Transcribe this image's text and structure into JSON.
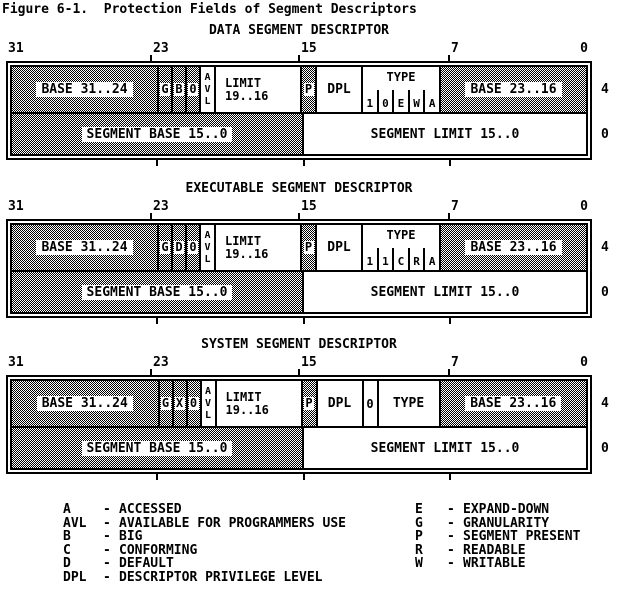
{
  "figure_title": "Figure 6-1.  Protection Fields of Segment Descriptors",
  "bit_labels": [
    "31",
    "23",
    "15",
    "7",
    "0"
  ],
  "descriptors": [
    {
      "title": "DATA SEGMENT DESCRIPTOR",
      "row_high": {
        "base_high": "BASE 31..24",
        "bit_g": "G",
        "bit_mid": "B",
        "bit_zero": "0",
        "avl": [
          "A",
          "V",
          "L"
        ],
        "limit_line1": "LIMIT",
        "limit_line2": "19..16",
        "bit_p": "P",
        "dpl": "DPL",
        "type_label": "TYPE",
        "type_bits": [
          "1",
          "0",
          "E",
          "W",
          "A"
        ],
        "base_mid": "BASE 23..16",
        "offset": "4"
      },
      "row_low": {
        "segment_base": "SEGMENT BASE 15..0",
        "segment_limit": "SEGMENT LIMIT 15..0",
        "offset": "0"
      }
    },
    {
      "title": "EXECUTABLE SEGMENT DESCRIPTOR",
      "row_high": {
        "base_high": "BASE 31..24",
        "bit_g": "G",
        "bit_mid": "D",
        "bit_zero": "0",
        "avl": [
          "A",
          "V",
          "L"
        ],
        "limit_line1": "LIMIT",
        "limit_line2": "19..16",
        "bit_p": "P",
        "dpl": "DPL",
        "type_label": "TYPE",
        "type_bits": [
          "1",
          "1",
          "C",
          "R",
          "A"
        ],
        "base_mid": "BASE 23..16",
        "offset": "4"
      },
      "row_low": {
        "segment_base": "SEGMENT BASE 15..0",
        "segment_limit": "SEGMENT LIMIT 15..0",
        "offset": "0"
      }
    },
    {
      "title": "SYSTEM SEGMENT DESCRIPTOR",
      "row_high": {
        "base_high": "BASE 31..24",
        "bit_g": "G",
        "bit_mid": "X",
        "bit_zero": "0",
        "avl": [
          "A",
          "V",
          "L"
        ],
        "limit_line1": "LIMIT",
        "limit_line2": "19..16",
        "bit_p": "P",
        "dpl": "DPL",
        "zero_field": "0",
        "type_label": "TYPE",
        "base_mid": "BASE 23..16",
        "offset": "4"
      },
      "row_low": {
        "segment_base": "SEGMENT BASE 15..0",
        "segment_limit": "SEGMENT LIMIT 15..0",
        "offset": "0"
      }
    }
  ],
  "legend": {
    "dash": "-",
    "left": [
      {
        "abbr": "A",
        "desc": "ACCESSED"
      },
      {
        "abbr": "AVL",
        "desc": "AVAILABLE FOR PROGRAMMERS USE"
      },
      {
        "abbr": "B",
        "desc": "BIG"
      },
      {
        "abbr": "C",
        "desc": "CONFORMING"
      },
      {
        "abbr": "D",
        "desc": "DEFAULT"
      },
      {
        "abbr": "DPL",
        "desc": "DESCRIPTOR PRIVILEGE LEVEL"
      }
    ],
    "right": [
      {
        "abbr": "E",
        "desc": "EXPAND-DOWN"
      },
      {
        "abbr": "G",
        "desc": "GRANULARITY"
      },
      {
        "abbr": "P",
        "desc": "SEGMENT PRESENT"
      },
      {
        "abbr": "R",
        "desc": "READABLE"
      },
      {
        "abbr": "W",
        "desc": "WRITABLE"
      }
    ]
  },
  "colors": {
    "foreground": "#000000",
    "background": "#ffffff"
  }
}
